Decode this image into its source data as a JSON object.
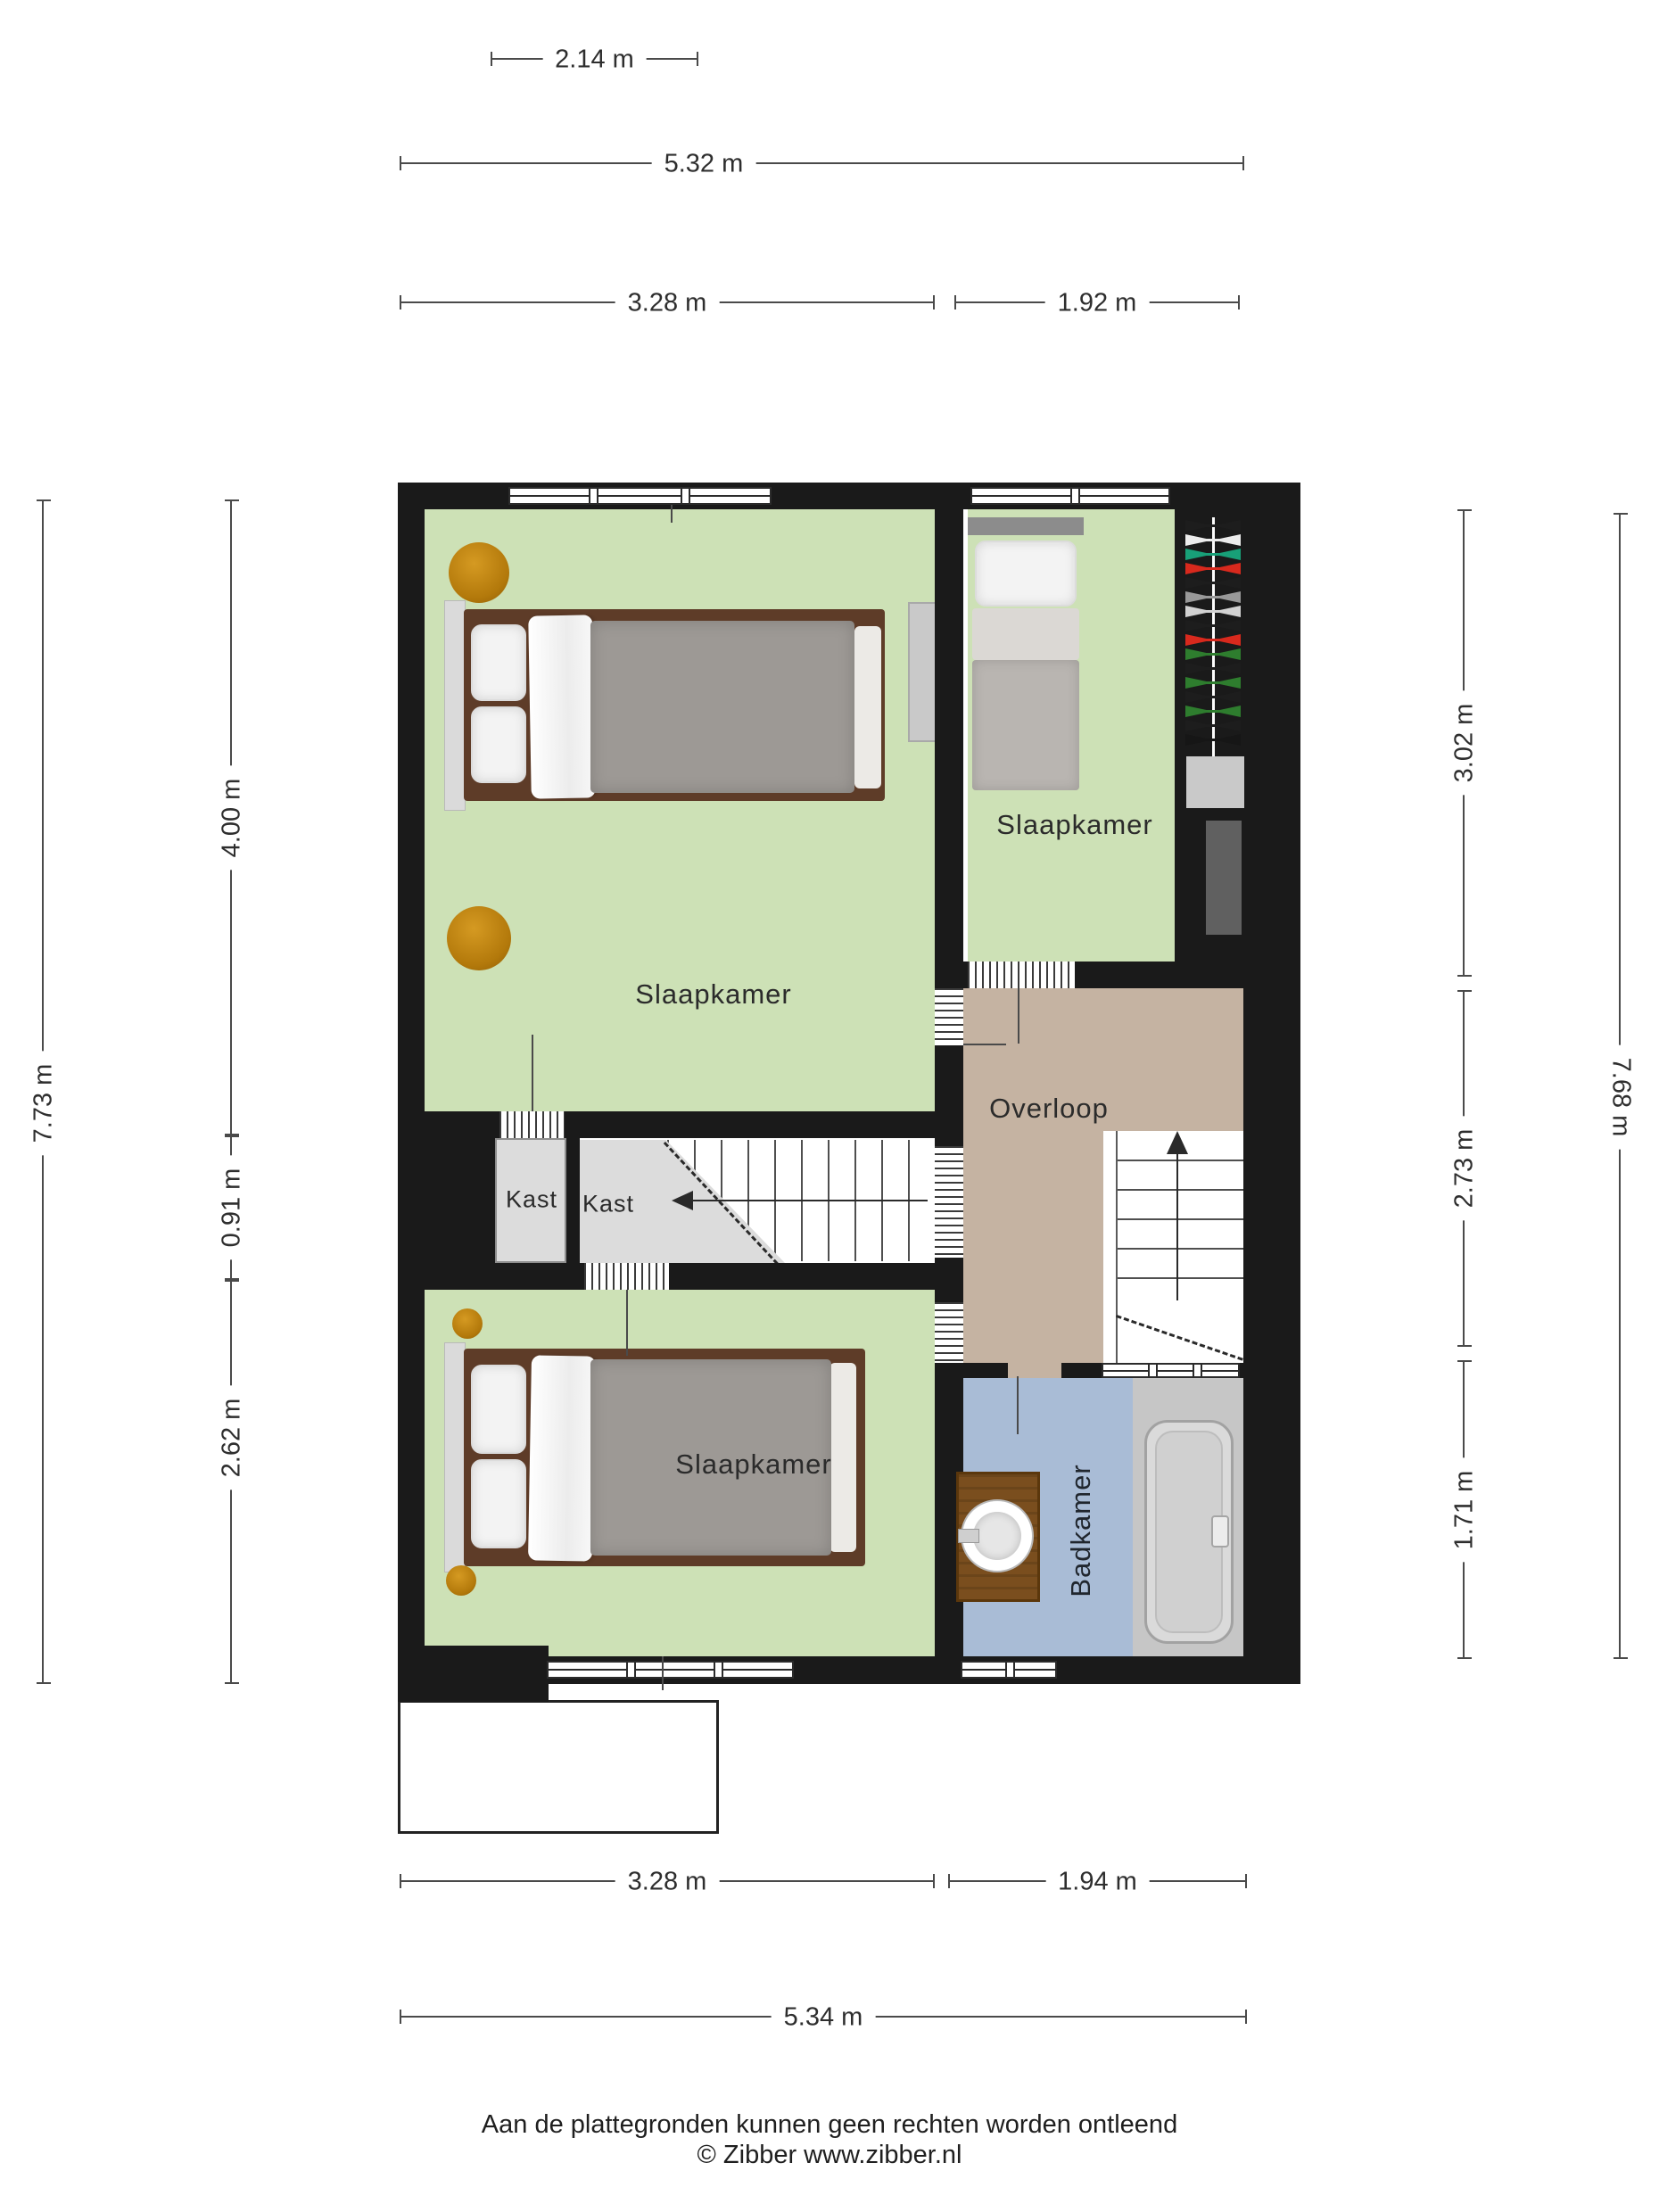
{
  "rooms": {
    "bedroom_main": "Slaapkamer",
    "bedroom_back": "Slaapkamer",
    "bedroom_front": "Slaapkamer",
    "closet_left": "Kast",
    "closet_right": "Kast",
    "landing": "Overloop",
    "bathroom": "Badkamer"
  },
  "dimensions": {
    "top_width_small": "2.14 m",
    "top_width_total": "5.32 m",
    "top_width_left": "3.28 m",
    "top_width_right": "1.92 m",
    "left_height_total": "7.73 m",
    "left_height_top": "4.00 m",
    "left_height_mid": "0.91 m",
    "left_height_bottom": "2.62 m",
    "right_height_top": "3.02 m",
    "right_height_mid": "2.73 m",
    "right_height_bottom": "1.71 m",
    "right_height_total": "7.68 m",
    "bottom_width_left": "3.28 m",
    "bottom_width_right": "1.94 m",
    "bottom_width_total": "5.34 m"
  },
  "footer": {
    "line1": "Aan de plattegronden kunnen geen rechten worden ontleend",
    "line2": "© Zibber www.zibber.nl"
  },
  "colors": {
    "wall": "#1a1a1a",
    "floor_green": "#cde1b6",
    "floor_tan": "#c5b3a2",
    "floor_blue": "#a9bcd6",
    "closet_gray": "#dcdcdc",
    "tub_zone_gray": "#c6c6c6",
    "wood_bed": "#5e3c28",
    "wood_vanity": "#7a4e1e",
    "pouf_orange": "#c9880f"
  },
  "wardrobe": {
    "items": [
      "#1d1d1d",
      "#ececec",
      "#18a078",
      "#d8291d",
      "#1d1d1d",
      "#999999",
      "#d2d2d2",
      "#1d1d1d",
      "#d8291d",
      "#2e7d2e",
      "#1d1d1d",
      "#2e7d2e",
      "#1d1d1d",
      "#2e7d2e",
      "#1d1d1d",
      "#161616"
    ]
  }
}
